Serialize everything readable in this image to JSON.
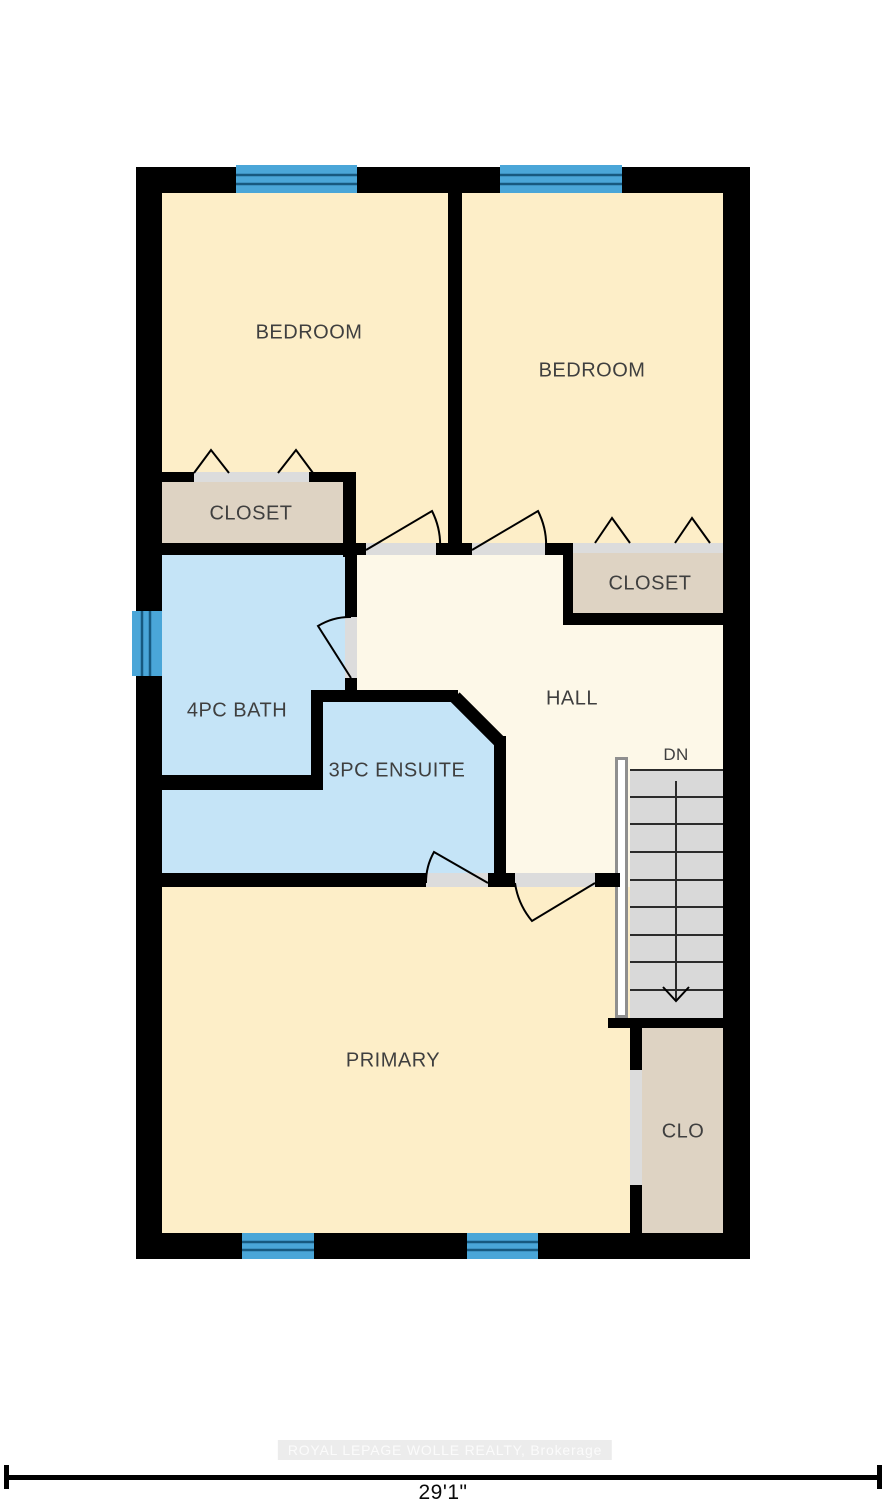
{
  "plan": {
    "title": "Second floor plan",
    "rooms": {
      "bedroom_left": {
        "label": "BEDROOM"
      },
      "bedroom_right": {
        "label": "BEDROOM"
      },
      "closet_left": {
        "label": "CLOSET"
      },
      "closet_right": {
        "label": "CLOSET"
      },
      "bath": {
        "label": "4PC BATH"
      },
      "ensuite": {
        "label": "3PC ENSUITE"
      },
      "hall": {
        "label": "HALL"
      },
      "primary": {
        "label": "PRIMARY"
      },
      "closet_primary": {
        "label": "CLO"
      }
    },
    "stairs": {
      "direction_label": "DN"
    },
    "dimension": {
      "overall_width": "29'1\""
    },
    "watermark": "ROYAL LEPAGE WOLLE REALTY, Brokerage",
    "colors": {
      "wall": "#000000",
      "bedroom_fill": "#fdeec8",
      "hall_fill": "#fdf8e8",
      "closet_fill": "#ded3c3",
      "bath_fill": "#c5e4f7",
      "window": "#4aa6d8",
      "window_line": "#17597f",
      "door_sill": "#dcdcdc",
      "stairs_fill": "#d9d9d9",
      "label_color": "#3f3f3f"
    }
  }
}
